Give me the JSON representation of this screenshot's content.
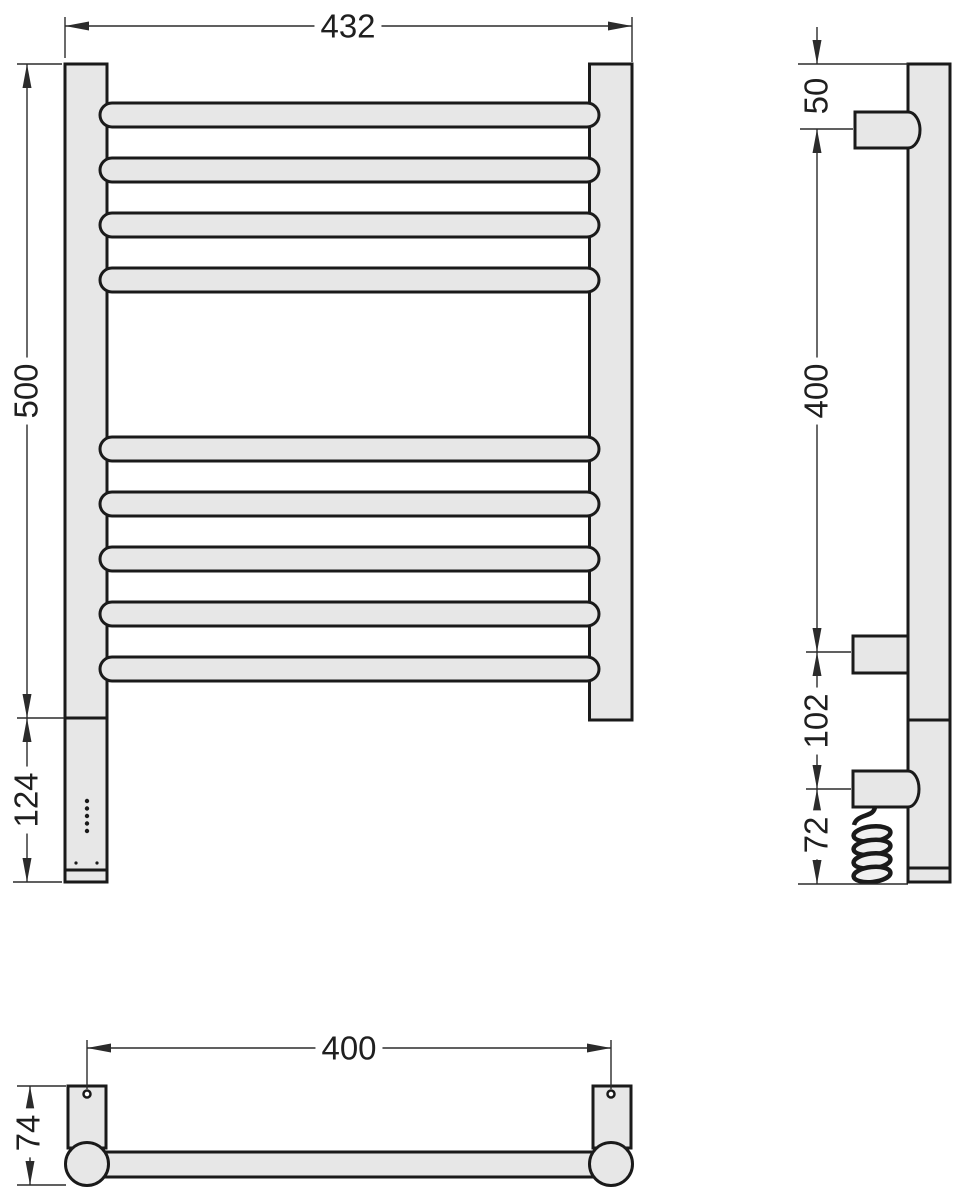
{
  "meta": {
    "background": "#ffffff",
    "fill_color": "#e7e7e7",
    "line_color": "#1a1a1a",
    "dim_color": "#2b2b2b"
  },
  "drawing": {
    "type": "technical-drawing",
    "subject": "ladder-style heated towel rail shown in front, side and bottom orthographic views with dimensions",
    "front_view": {
      "width": "432",
      "height": "500",
      "heater_section_height": "124"
    },
    "side_view": {
      "top_to_bracket": "50",
      "bracket_span": "400",
      "bracket_to_outlet": "102",
      "outlet_to_bottom": "72"
    },
    "bottom_view": {
      "mounting_span": "400",
      "depth": "74"
    }
  }
}
